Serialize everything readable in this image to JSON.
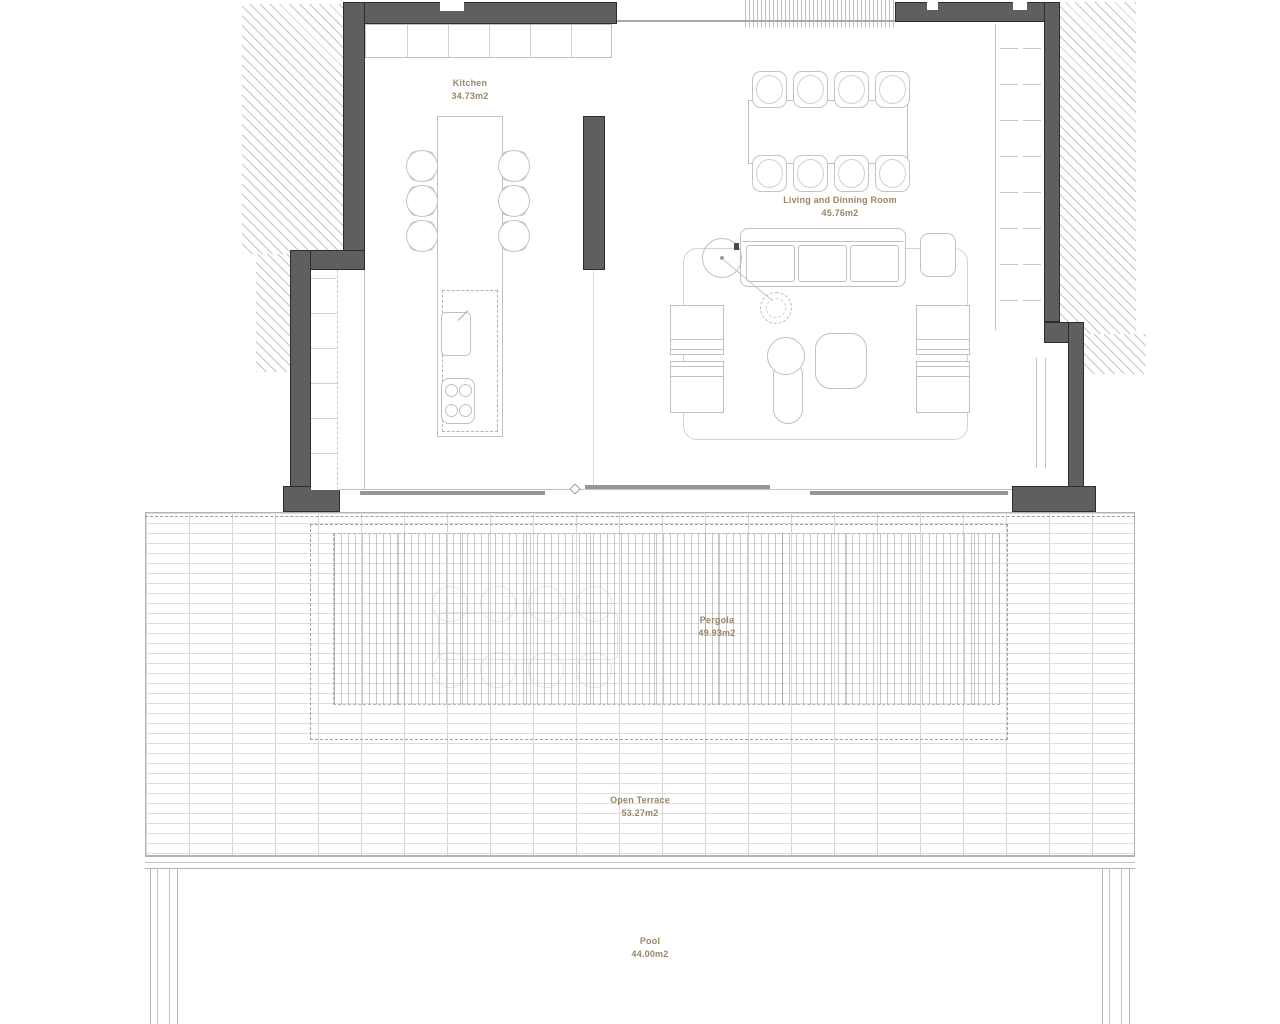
{
  "document": {
    "type": "architectural-floor-plan"
  },
  "rooms": {
    "kitchen": {
      "name": "Kitchen",
      "area": "34.73m2"
    },
    "living": {
      "name": "Living and Dinning Room",
      "area": "45.76m2"
    },
    "pergola": {
      "name": "Pergola",
      "area": "49.93m2"
    },
    "open_terrace": {
      "name": "Open Terrace",
      "area": "53.27m2"
    },
    "pool": {
      "name": "Pool",
      "area": "44.00m2"
    }
  },
  "colors": {
    "wall": "#5f5f5f",
    "wall_outline": "#2d2d2d",
    "furniture_line": "#c0c0c0",
    "grid_line": "#d9d9d9",
    "label_text": "#998668",
    "background": "#ffffff"
  }
}
